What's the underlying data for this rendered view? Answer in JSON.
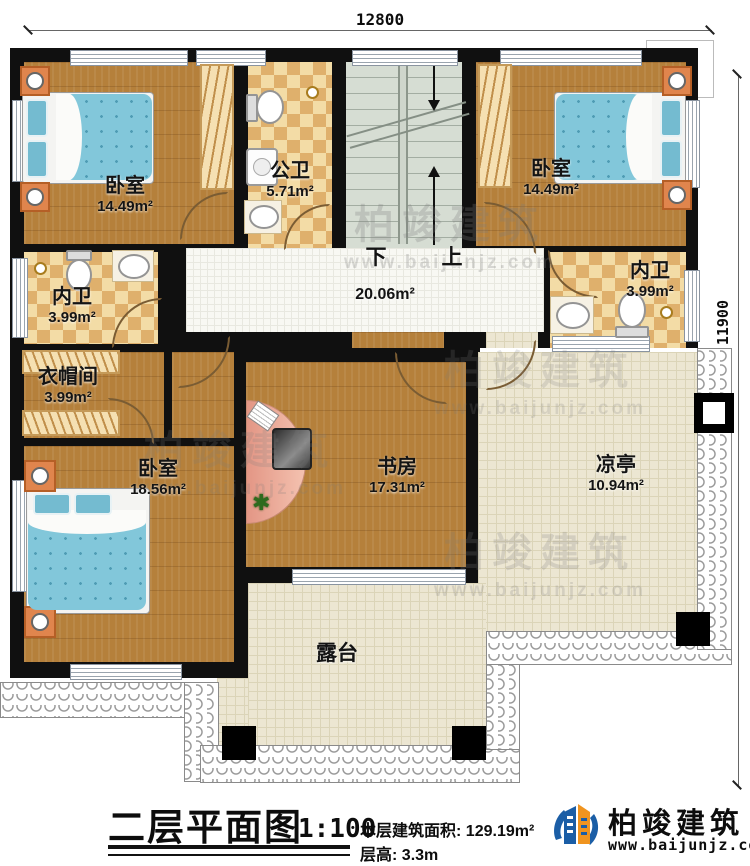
{
  "dims": {
    "top": "12800",
    "right": "11900"
  },
  "stairs": {
    "down": "下",
    "up": "上"
  },
  "rooms": {
    "bedroom_tl": {
      "name": "卧室",
      "area": "14.49m²"
    },
    "public_bath": {
      "name": "公卫",
      "area": "5.71m²"
    },
    "bedroom_tr": {
      "name": "卧室",
      "area": "14.49m²"
    },
    "bath_right": {
      "name": "内卫",
      "area": "3.99m²"
    },
    "bath_left": {
      "name": "内卫",
      "area": "3.99m²"
    },
    "cloakroom": {
      "name": "衣帽间",
      "area": "3.99m²"
    },
    "bedroom_bl": {
      "name": "卧室",
      "area": "18.56m²"
    },
    "study": {
      "name": "书房",
      "area": "17.31m²"
    },
    "pavilion": {
      "name": "凉亭",
      "area": "10.94m²"
    },
    "hallway": {
      "area": "20.06m²"
    },
    "terrace": {
      "name": "露台"
    }
  },
  "titleblock": {
    "title": "二层平面图",
    "scale": "1:100",
    "area_label": "本层建筑面积:",
    "area_value": "129.19m²",
    "height_label": "层高:",
    "height_value": "3.3m"
  },
  "brand": {
    "name": "柏竣建筑",
    "url": "www.baijunjz.com"
  },
  "watermark": {
    "name": "柏竣建筑",
    "url": "www.baijunjz.com"
  },
  "colors": {
    "wall": "#101010",
    "wood_floor": "#b5803b",
    "bath_tile_dark": "#dfb06c",
    "bath_tile_light": "#f3dca6",
    "stair": "#d6ddd3",
    "terrace_tile": "#ece6d2",
    "bed_blue": "#82c7da",
    "desk_salmon": "#eda391",
    "logo_blue": "#1b5ea6",
    "logo_orange": "#f0941f"
  }
}
